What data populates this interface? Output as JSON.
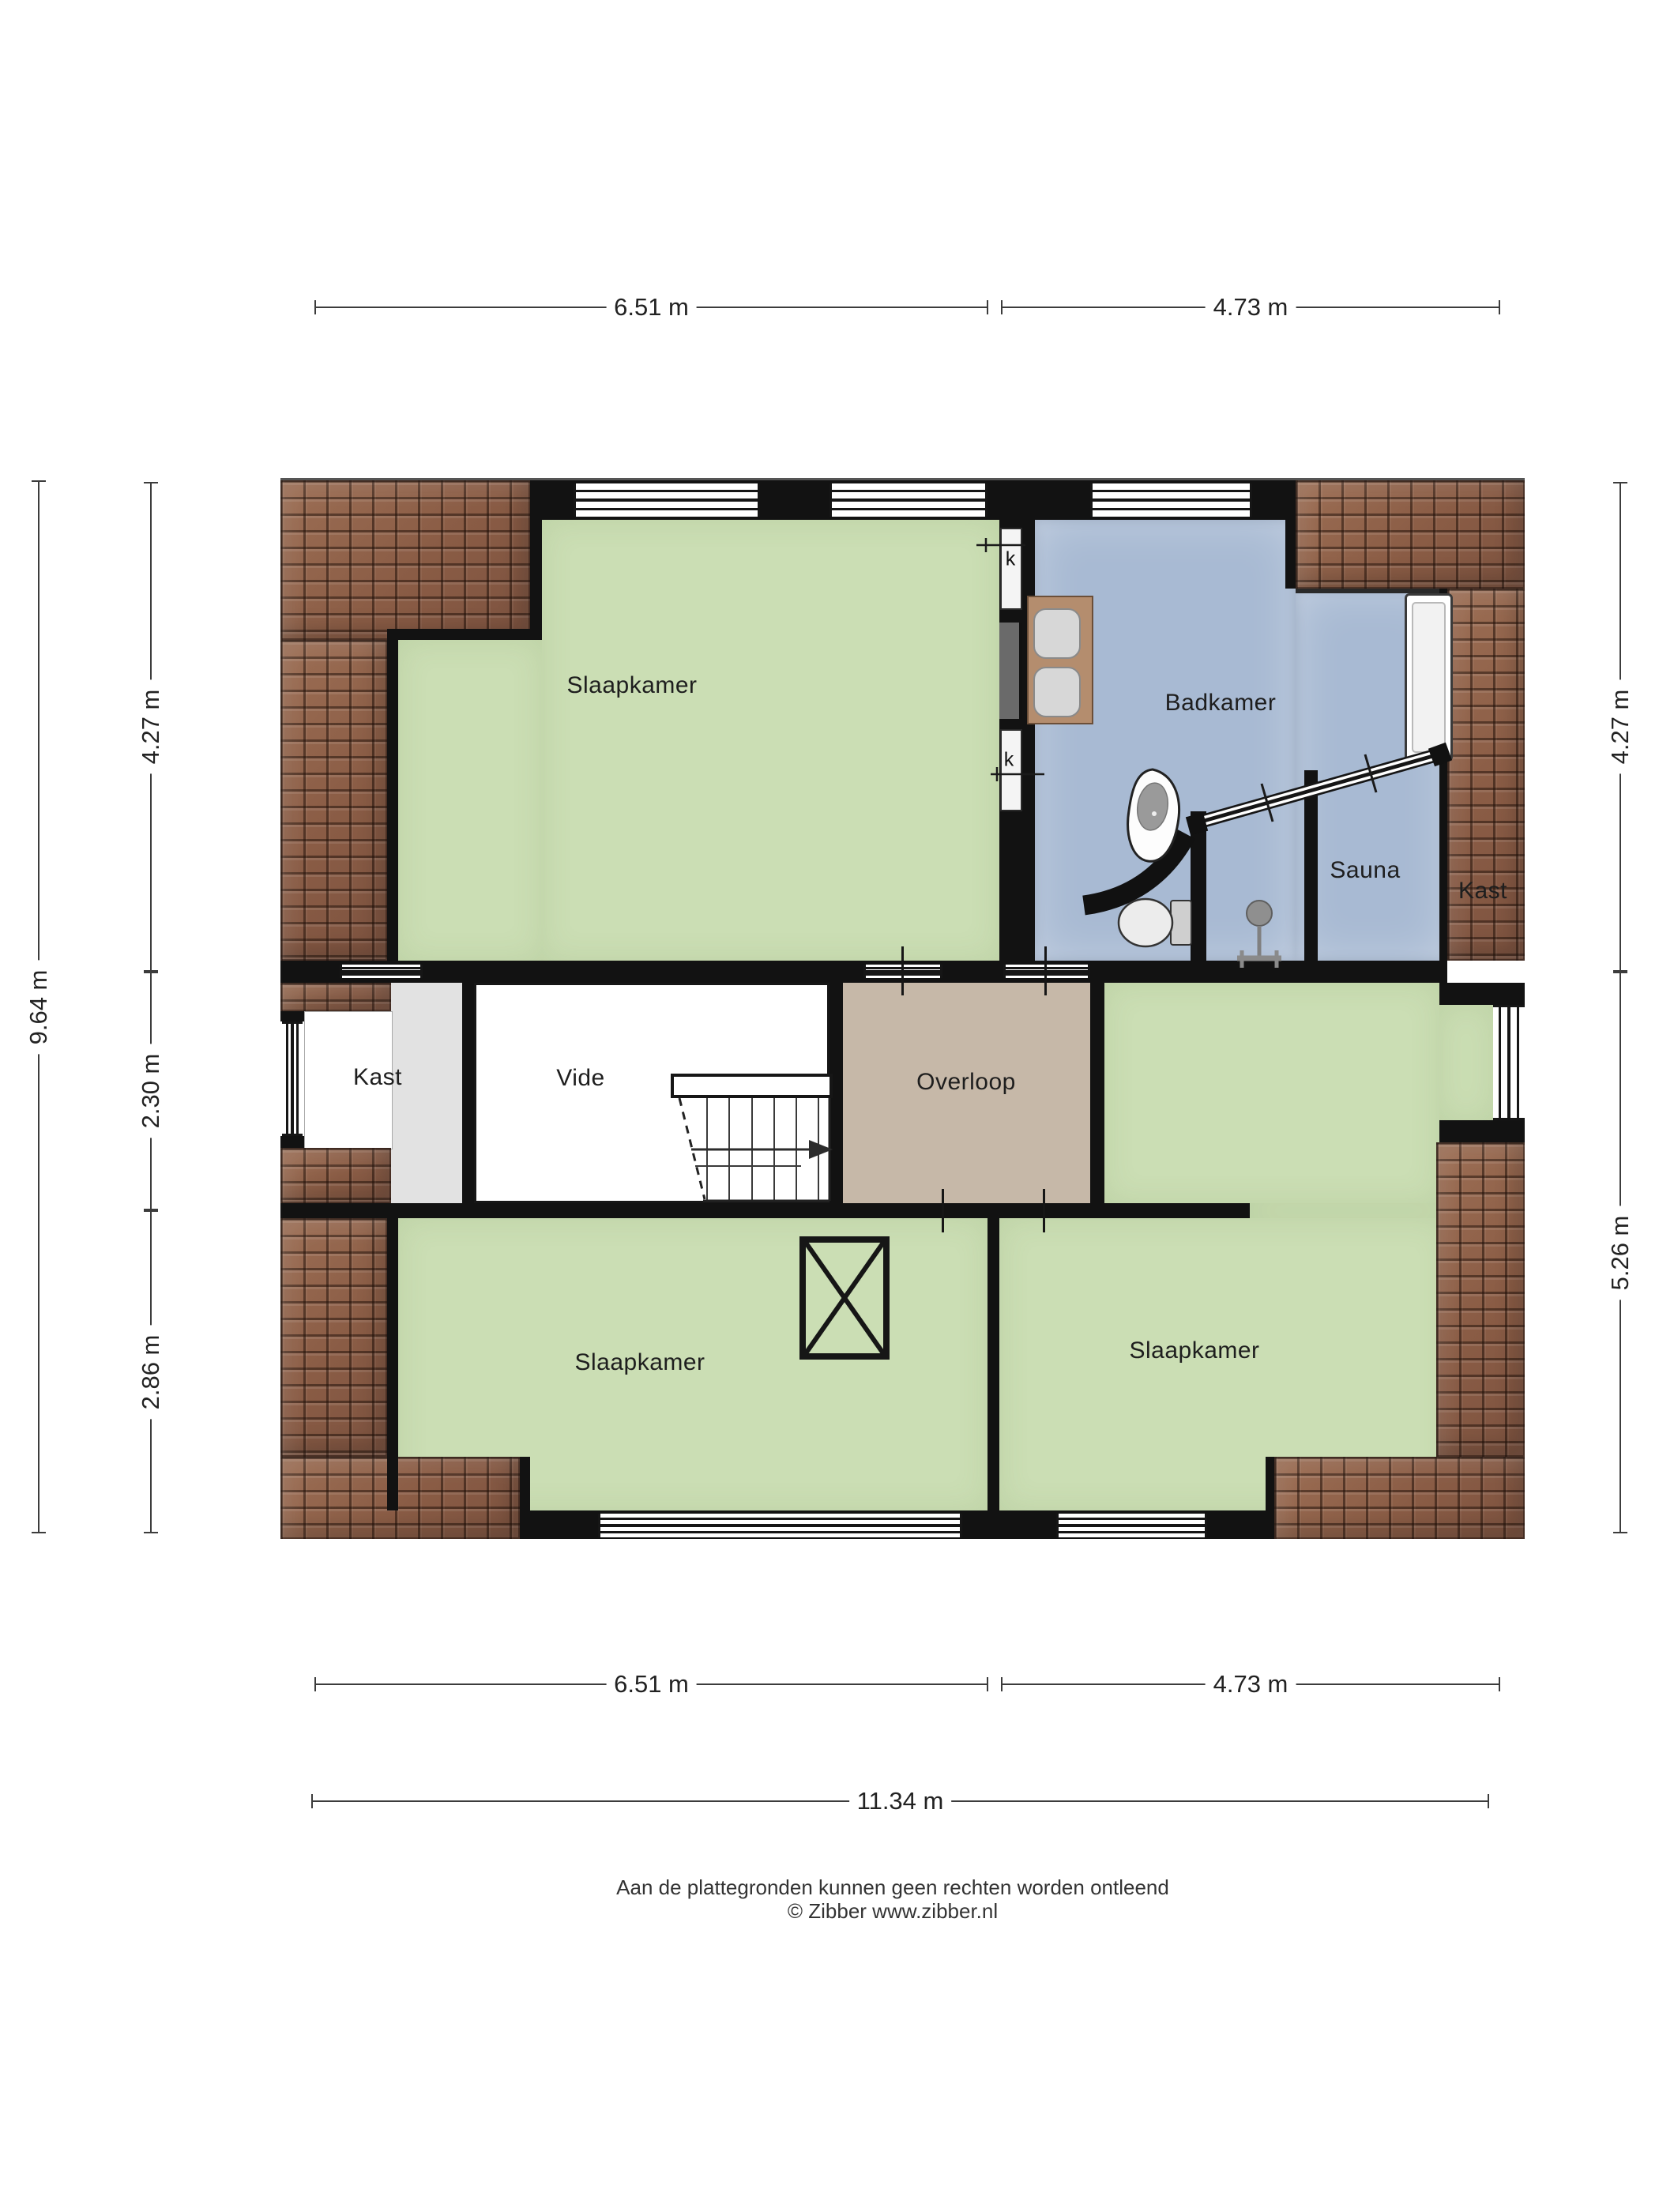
{
  "labels": {
    "bedroom_tl": "Slaapkamer",
    "bathroom": "Badkamer",
    "sauna": "Sauna",
    "closet_right": "Kast",
    "closet_left": "Kast",
    "void_room": "Vide",
    "landing": "Overloop",
    "bedroom_bl": "Slaapkamer",
    "bedroom_br": "Slaapkamer"
  },
  "marks": {
    "k1": "k",
    "k2": "k"
  },
  "dimensions": {
    "top_left": "6.51 m",
    "top_right": "4.73 m",
    "left_total": "9.64 m",
    "left_top": "4.27 m",
    "left_mid": "2.30 m",
    "left_bottom": "2.86 m",
    "right_top": "4.27 m",
    "right_bottom": "5.26 m",
    "bottom_left": "6.51 m",
    "bottom_right": "4.73 m",
    "bottom_total": "11.34 m"
  },
  "footer": {
    "disclaimer": "Aan de plattegronden kunnen geen rechten worden ontleend",
    "copyright": "© Zibber www.zibber.nl"
  },
  "colors": {
    "floor_bedroom": "#cbdeb4",
    "floor_bathroom": "#a8bad3",
    "floor_landing": "#c6b8a8",
    "floor_closet": "#e2e2e2",
    "roof_tiles": "#96684f",
    "walls": "#121212"
  }
}
